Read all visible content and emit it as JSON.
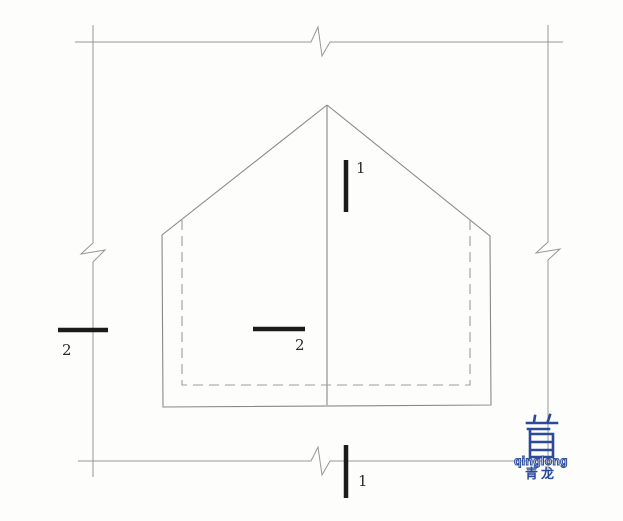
{
  "colors": {
    "grid_line": "#979797",
    "outline_line": "#898989",
    "dashed_line": "#9d9d9d",
    "section_marker": "#1b1b1b",
    "logo_blue": "#2b4a9c",
    "paper": "#fdfdfb"
  },
  "geometry": {
    "top_border": "75,42 311,42 318,27 322,56 330,42 563,42",
    "left_border": "93,25 93,243 81,254 105,250 93,262 93,477",
    "right_border": "548,25 548,242 536,253 560,249 548,260 548,475",
    "bottom_border": "78,461 311,461 318,447 322,475 330,461 556,461",
    "house_outline": "327,105 162,235 163,407 491,405 490,236 327,105",
    "ridge_line": "327,105 327,405",
    "inner_dashed": "182,220 182,385 470,385 470,220",
    "dash_pattern": "10 6",
    "marker_1_top": "346,160 346,212",
    "marker_1_bottom": "346,445 346,498",
    "marker_2_left": "58,330 108,330",
    "marker_2_inner": "253,329 305,329",
    "logo_glyph_path": "M534,422 l1,-6 M548,421 l2,-6 M527,423 h30 M528,429 h21 M530,429 v28 M530,434 h23 M553,434 v23 M530,442 h23 M530,450 h23 M530,457 h23"
  },
  "section_labels": {
    "top_1": "1",
    "bottom_1": "1",
    "left_2": "2",
    "inner_2": "2"
  },
  "logo": {
    "wordmark": "qinglong",
    "chinese": "青龙"
  }
}
